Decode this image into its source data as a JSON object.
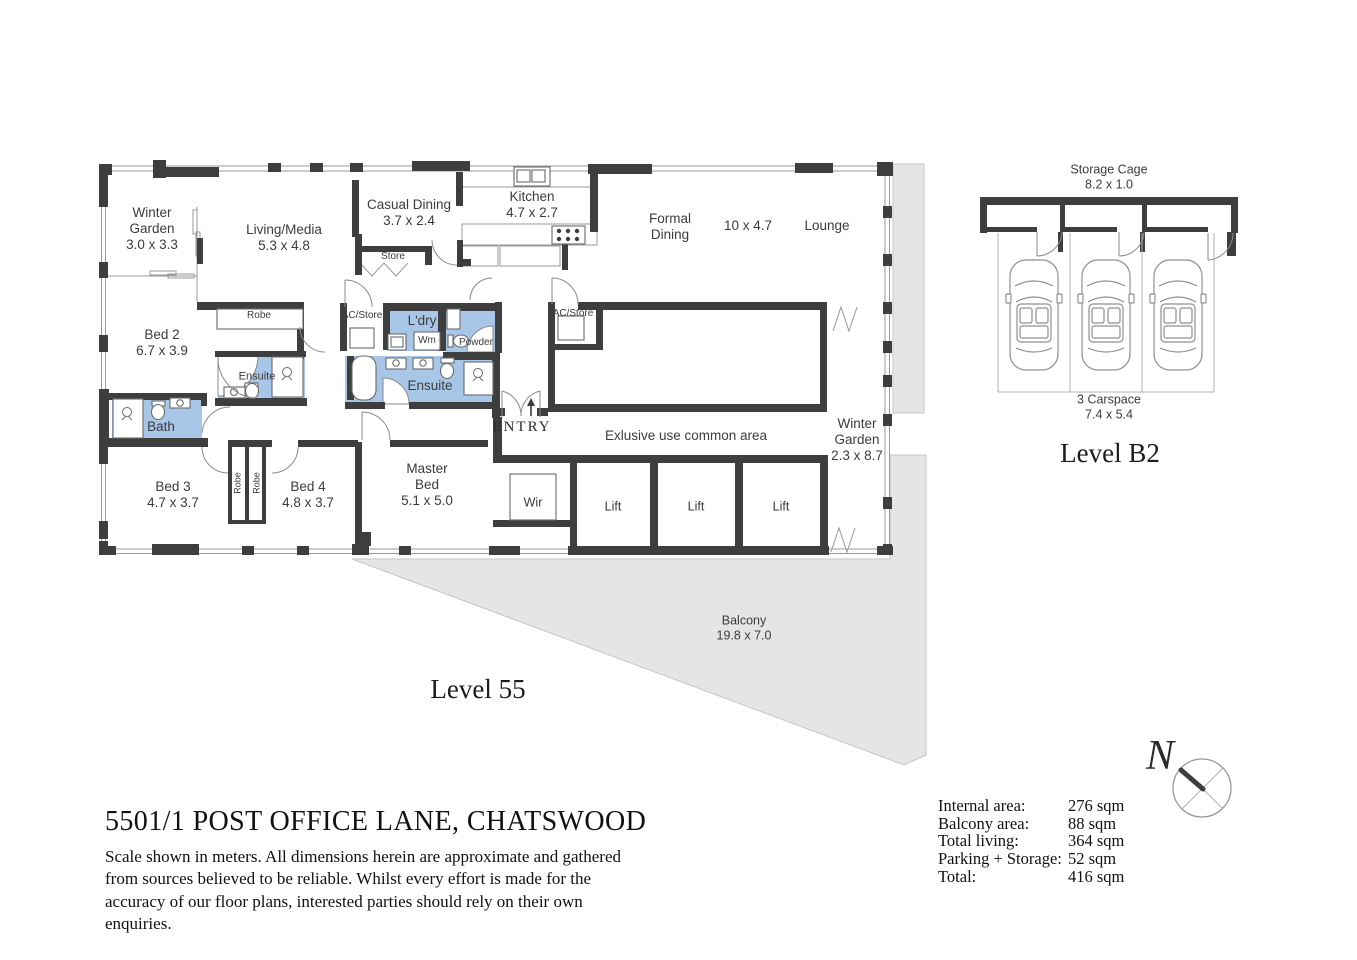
{
  "header": {
    "title": "5501/1 POST OFFICE LANE, CHATSWOOD",
    "disclaimer": "Scale shown in meters. All dimensions herein are approximate and gathered from sources believed to be reliable. Whilst every effort is made for the accuracy of our floor plans, interested parties should rely on their own enquiries."
  },
  "plan": {
    "level_label": "Level 55",
    "entry_label": "ENTRY",
    "common_area_label": "Exlusive use common area",
    "rooms": {
      "winter_garden_nw": {
        "name": "Winter\nGarden",
        "dims": "3.0 x 3.3"
      },
      "living_media": {
        "name": "Living/Media",
        "dims": "5.3 x 4.8"
      },
      "casual_dining": {
        "name": "Casual Dining",
        "dims": "3.7 x 2.4"
      },
      "store": {
        "name": "Store"
      },
      "kitchen": {
        "name": "Kitchen",
        "dims": "4.7 x 2.7"
      },
      "formal_dining": {
        "name": "Formal\nDining"
      },
      "living_lounge_dims": "10 x 4.7",
      "lounge": {
        "name": "Lounge"
      },
      "robe_bed2": {
        "name": "Robe"
      },
      "bed2": {
        "name": "Bed 2",
        "dims": "6.7 x 3.9"
      },
      "ac_store_w": {
        "name": "AC/Store"
      },
      "ldry": {
        "name": "L'dry"
      },
      "wm": {
        "name": "Wm"
      },
      "powder": {
        "name": "Powder"
      },
      "ensuite_bed2": {
        "name": "Ensuite"
      },
      "bath": {
        "name": "Bath"
      },
      "ensuite_master": {
        "name": "Ensuite"
      },
      "ac_store_e": {
        "name": "AC/Store"
      },
      "winter_garden_e": {
        "name": "Winter\nGarden",
        "dims": "2.3 x 8.7"
      },
      "bed3": {
        "name": "Bed 3",
        "dims": "4.7 x 3.7"
      },
      "robe_left": {
        "name": "Robe"
      },
      "robe_right": {
        "name": "Robe"
      },
      "bed4": {
        "name": "Bed 4",
        "dims": "4.8 x 3.7"
      },
      "master_bed": {
        "name": "Master\nBed",
        "dims": "5.1 x 5.0"
      },
      "wir": {
        "name": "Wir"
      },
      "lift": {
        "name": "Lift"
      },
      "balcony": {
        "name": "Balcony",
        "dims": "19.8 x 7.0"
      }
    }
  },
  "garage": {
    "level_label": "Level B2",
    "storage_cage": {
      "name": "Storage Cage",
      "dims": "8.2 x 1.0"
    },
    "carspace": {
      "name": "3 Carspace",
      "dims": "7.4 x 5.4"
    }
  },
  "compass": {
    "north_label": "N"
  },
  "areas": {
    "rows": [
      {
        "label": "Internal area:",
        "value": "276 sqm"
      },
      {
        "label": "Balcony area:",
        "value": "88 sqm"
      },
      {
        "label": "Total living:",
        "value": "364 sqm"
      },
      {
        "label": "Parking + Storage:",
        "value": "52 sqm"
      },
      {
        "label": "Total:",
        "value": "416 sqm"
      }
    ]
  },
  "colors": {
    "wall": "#3e3e3e",
    "wet_area_blue": "#a8c6e8",
    "balcony_gray": "#e5e5e5"
  }
}
